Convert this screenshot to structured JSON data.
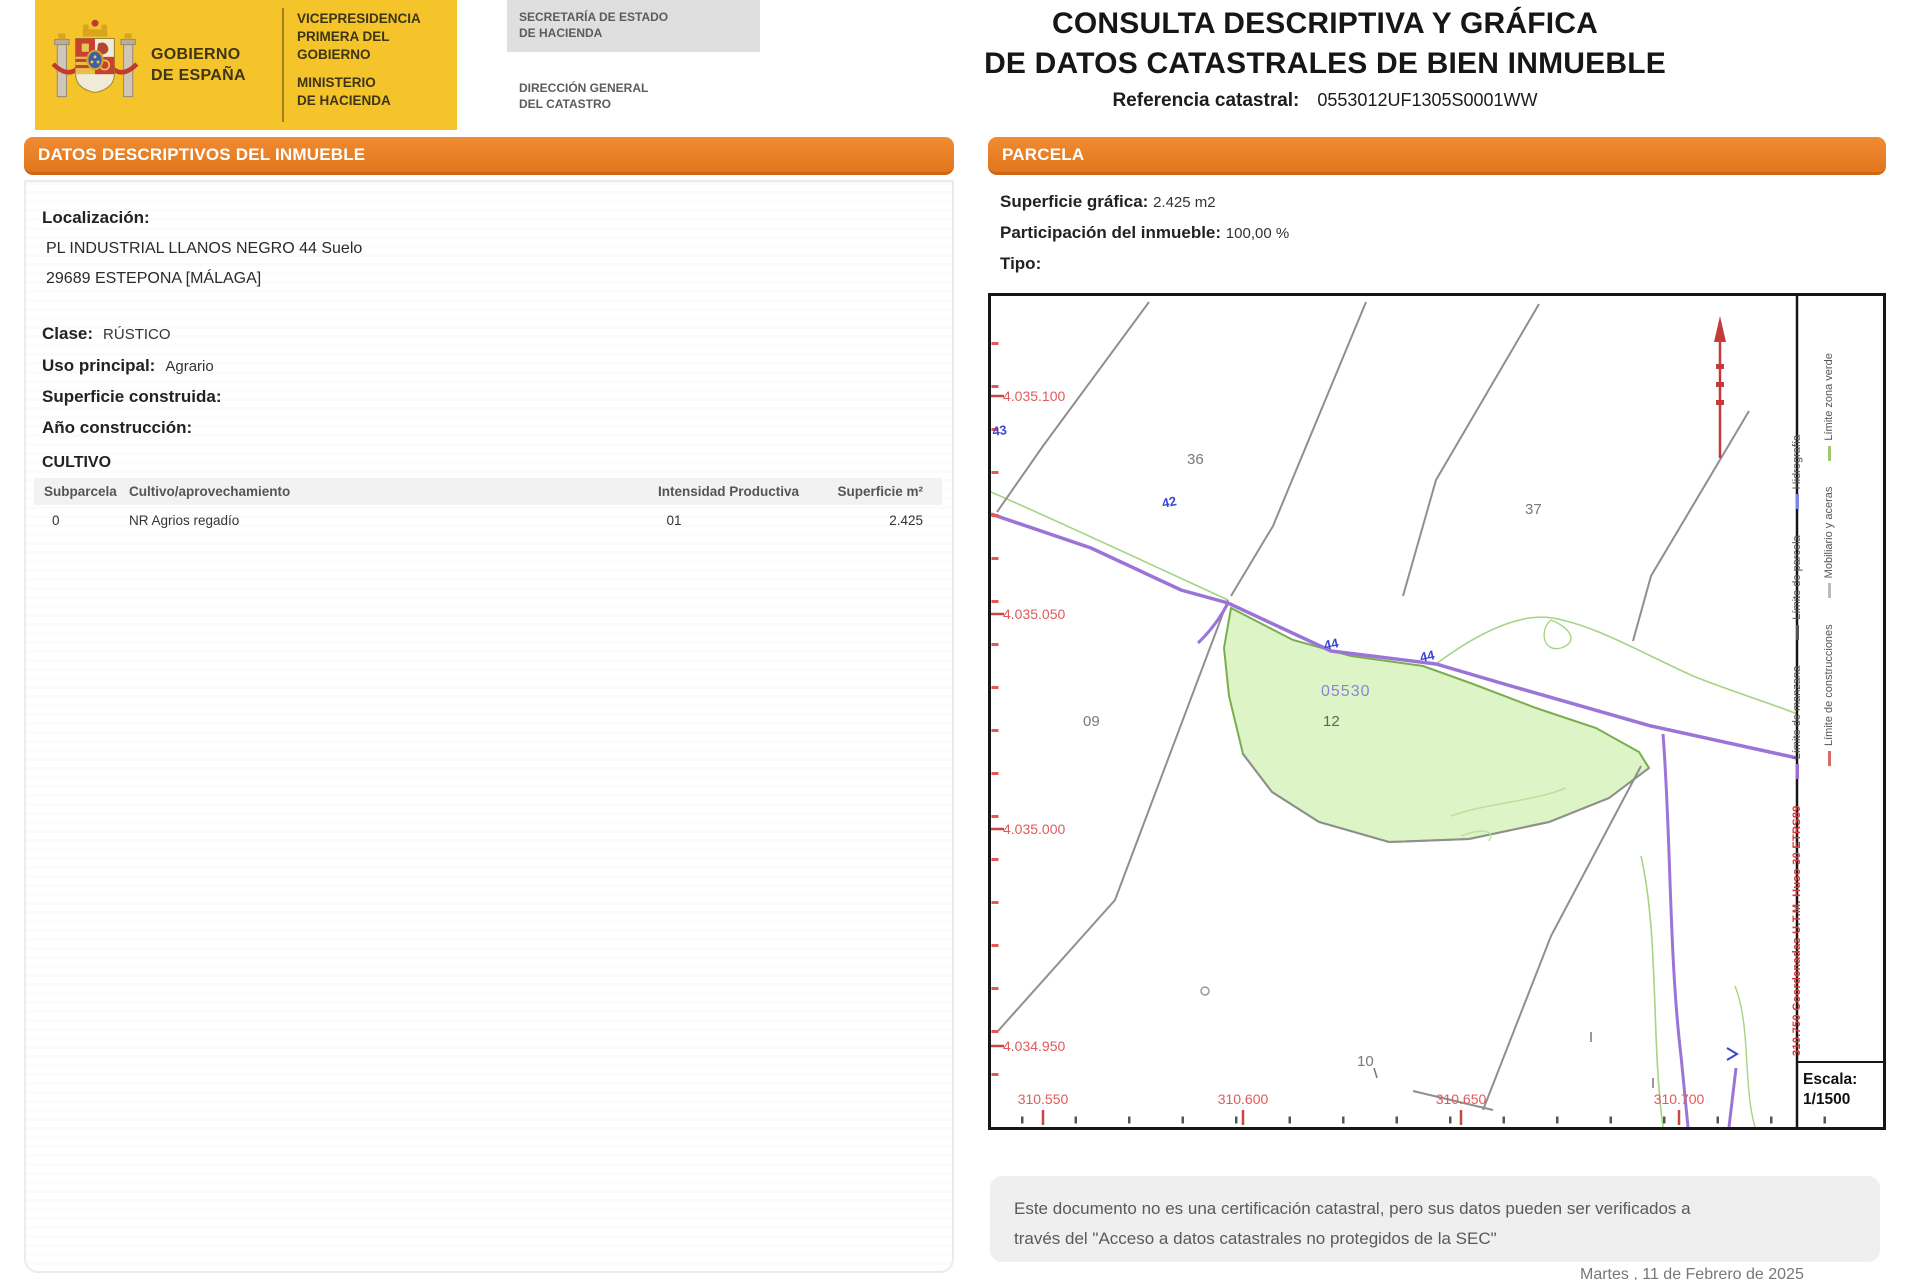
{
  "header": {
    "logo": {
      "gobierno_line1": "GOBIERNO",
      "gobierno_line2": "DE ESPAÑA",
      "vice_line1": "VICEPRESIDENCIA",
      "vice_line2": "PRIMERA DEL GOBIERNO",
      "ministerio_line1": "MINISTERIO",
      "ministerio_line2": "DE HACIENDA",
      "secretaria_line1": "SECRETARÍA DE ESTADO",
      "secretaria_line2": "DE HACIENDA",
      "direccion_line1": "DIRECCIÓN GENERAL",
      "direccion_line2": "DEL CATASTRO"
    },
    "title_line1": "CONSULTA DESCRIPTIVA Y GRÁFICA",
    "title_line2": "DE DATOS CATASTRALES DE BIEN INMUEBLE",
    "ref_label": "Referencia catastral:",
    "ref_value": "0553012UF1305S0001WW"
  },
  "left": {
    "section_title": "DATOS DESCRIPTIVOS DEL INMUEBLE",
    "localizacion_label": "Localización:",
    "address_line1": "PL INDUSTRIAL LLANOS NEGRO 44 Suelo",
    "address_line2": "29689 ESTEPONA [MÁLAGA]",
    "clase_label": "Clase:",
    "clase_value": "RÚSTICO",
    "uso_label": "Uso principal:",
    "uso_value": "Agrario",
    "superficie_label": "Superficie construida:",
    "superficie_value": "",
    "anio_label": "Año construcción:",
    "anio_value": "",
    "cultivo_title": "CULTIVO",
    "table": {
      "headers": [
        "Subparcela",
        "Cultivo/aprovechamiento",
        "Intensidad Productiva",
        "Superficie m²"
      ],
      "rows": [
        [
          "0",
          "NR Agrios regadío",
          "01",
          "2.425"
        ]
      ]
    }
  },
  "right": {
    "section_title": "PARCELA",
    "superficie_grafica_label": "Superficie gráfica:",
    "superficie_grafica_value": "2.425 m2",
    "participacion_label": "Participación del inmueble:",
    "participacion_value": "100,00 %",
    "tipo_label": "Tipo:",
    "tipo_value": ""
  },
  "map": {
    "y_labels": [
      "4.035.100",
      "4.035.050",
      "4.035.000",
      "4.034.950"
    ],
    "x_labels": [
      "310.550",
      "310.600",
      "310.650",
      "310.700"
    ],
    "parcel_numbers": [
      "36",
      "37",
      "09",
      "12",
      "10"
    ],
    "parcel_ref": "05530",
    "blue_labels": [
      "43",
      "42",
      "44",
      "44"
    ],
    "legend_col1": [
      {
        "label": "Límite de manzana",
        "color": "#9A6FD4"
      },
      {
        "label": "Límite de parcela",
        "color": "#555555"
      },
      {
        "label": "Hidrografía",
        "color": "#7B86E8"
      }
    ],
    "legend_col2": [
      {
        "label": "Límite de construcciones",
        "color": "#D86A6A"
      },
      {
        "label": "Mobiliario y aceras",
        "color": "#BBBBBB"
      },
      {
        "label": "Límite zona verde",
        "color": "#9CCB6B"
      }
    ],
    "utm_note": "310.750 Coordenadas U.T.M. Huso 30 ETRS89",
    "escala_label": "Escala:",
    "escala_value": "1/1500",
    "colors": {
      "road": "#9B74D8",
      "parcel_fill": "#DCF4C6",
      "parcel_edge": "#79AE4F",
      "boundary": "#8F8F8F",
      "coordinates": "#E05A5A"
    }
  },
  "footer": {
    "disclaimer_line1": "Este documento no es una certificación catastral, pero sus datos pueden ser verificados a",
    "disclaimer_line2": "través del \"Acceso a datos catastrales no protegidos de la SEC\"",
    "date_note": "Martes , 11 de Febrero de 2025"
  }
}
